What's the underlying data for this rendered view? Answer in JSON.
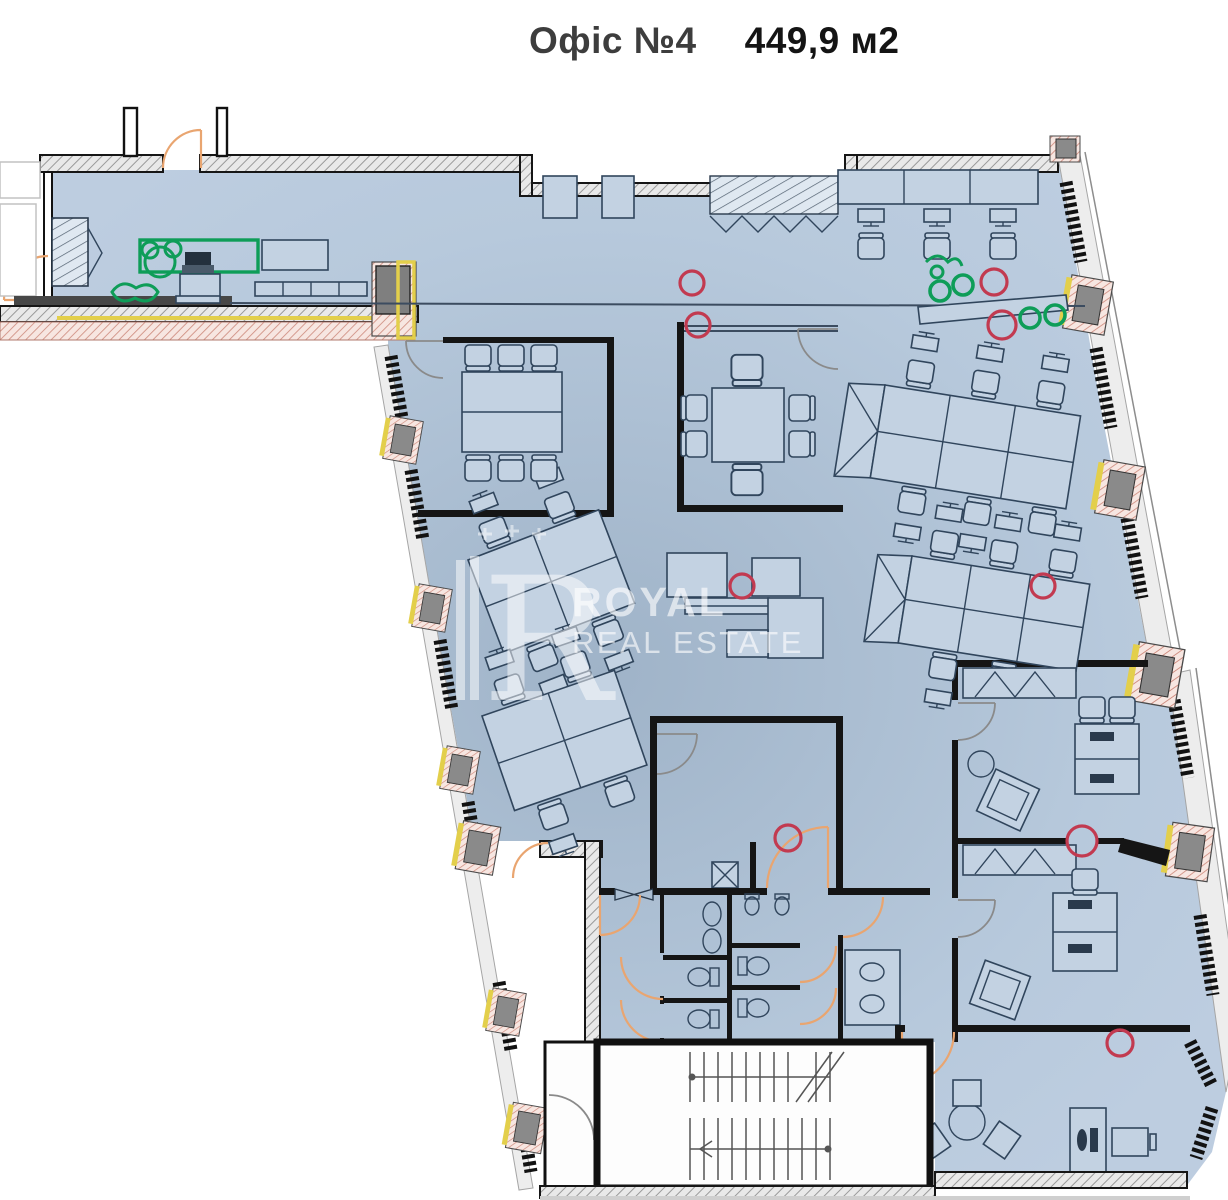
{
  "title": {
    "office_label": "Офіс №4",
    "area_label": "449,9 м2"
  },
  "watermark": {
    "monogram": "R",
    "brand_top": "ROYAL",
    "brand_bottom": "REAL ESTATE"
  },
  "colors": {
    "floor_fill": "#b7c9dc",
    "floor_center": "#9fb3c8",
    "wall": "#151515",
    "accent_red": "#c23a50",
    "accent_green": "#0e9d58",
    "door_orange": "#e9a570",
    "trim_yellow": "#e3cf4b",
    "furn_line": "#30455c",
    "furn_fill": "#c3d2e2",
    "wm": "#ffffff"
  },
  "markers": {
    "red": [
      {
        "x": 692,
        "y": 283,
        "r": 12
      },
      {
        "x": 698,
        "y": 325,
        "r": 12
      },
      {
        "x": 994,
        "y": 282,
        "r": 13
      },
      {
        "x": 1002,
        "y": 325,
        "r": 14
      },
      {
        "x": 742,
        "y": 586,
        "r": 12
      },
      {
        "x": 1043,
        "y": 586,
        "r": 12
      },
      {
        "x": 788,
        "y": 838,
        "r": 13
      },
      {
        "x": 1082,
        "y": 841,
        "r": 15
      },
      {
        "x": 1120,
        "y": 1043,
        "r": 13
      }
    ],
    "green": [
      {
        "x": 940,
        "y": 291,
        "r": 10
      },
      {
        "x": 963,
        "y": 285,
        "r": 10
      },
      {
        "x": 1030,
        "y": 318,
        "r": 10
      },
      {
        "x": 1055,
        "y": 315,
        "r": 10
      }
    ]
  }
}
